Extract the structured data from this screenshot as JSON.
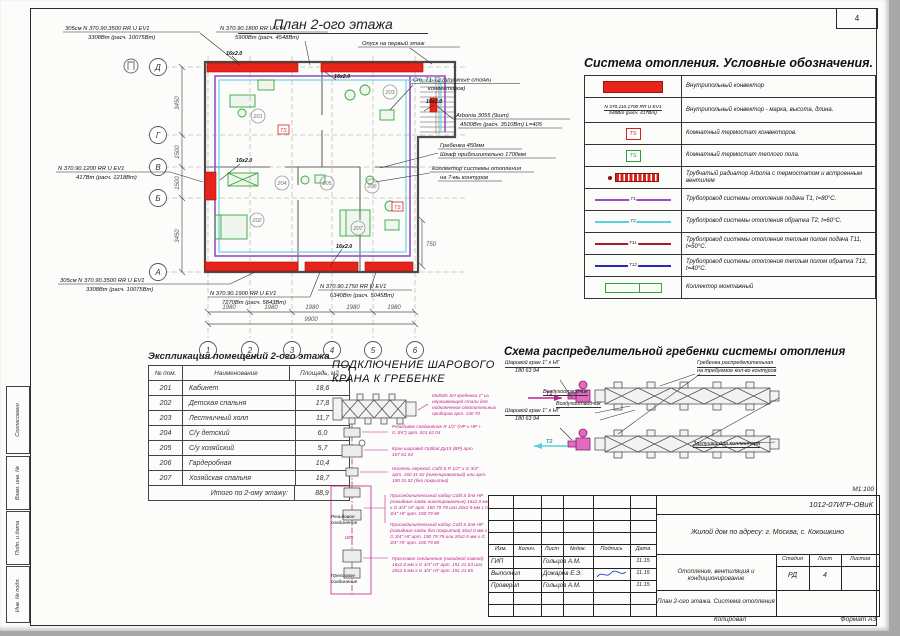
{
  "page": {
    "sheet_number": "4",
    "scale_note": "М1:100",
    "copied_label": "Копировал",
    "format_label": "Формат А3"
  },
  "margin": {
    "agreed": "Согласовано",
    "vzam_inv": "Взам. инв. №",
    "podp_data": "Подп. и дата",
    "inv_podl": "Инв. № подл."
  },
  "plan": {
    "title": "План 2-ого этажа",
    "axes_rows": [
      "Д",
      "Г",
      "В",
      "Б",
      "А"
    ],
    "axes_cols": [
      "1",
      "2",
      "3",
      "4",
      "5",
      "6"
    ],
    "dims_left": [
      "3450",
      "1500",
      "1500",
      "3450"
    ],
    "dims_bottom": [
      "1980",
      "1980",
      "1980",
      "1980",
      "1980"
    ],
    "dim_total": "9900",
    "dim_right": "750",
    "pipe_tag": "16х2.0",
    "ts_badge": "TS",
    "rooms": [
      "201",
      "202",
      "203",
      "204",
      "205",
      "206",
      "207"
    ],
    "ann": {
      "conv_tl1": "305см N 370.90.3500 RR U EV1",
      "conv_tl2": "3308Вт (расч. 10075Вт)",
      "conv_tc1": "N 370.90.1800 RR U EV1",
      "conv_tc2": "5900Вт (расч. 4548Вт)",
      "drop": "Опуск на первый этаж",
      "risers1": "Ст. Т1-Т2 (опускные стояки",
      "risers2": "конвекторов)",
      "arbonia1": "Arbonia 3055 (9шт)",
      "arbonia2": "4500Вт (расч. 3510Вт) L=405",
      "comb1": "Гребенка 450мм",
      "comb2": "Шкаф приблизительно 1700мм",
      "coll1": "Коллектор системы отопления",
      "coll2": "на 7-мь контуров",
      "conv_l1": "N 370.90.1200 RR U EV1",
      "conv_l2": "417Вт (расч. 1218Вт)",
      "conv_bl1": "305см N 370.90.3500 RR U EV1",
      "conv_bl2": "3308Вт (расч. 10075Вт)",
      "conv_bc1": "N 370.90.1900 RR U EV1",
      "conv_bc2": "7270Вт (расч. 5843Вт)",
      "conv_br1": "N 370.90.1750 RR U EV1",
      "conv_br2": "6340Вт (расч. 5045Вт)"
    }
  },
  "legend": {
    "title": "Система отопления. Условные обозначения.",
    "rows": [
      {
        "symbol": "red-bar-symbol",
        "desc": "Внутрипольный конвектор"
      },
      {
        "symbol": "convector-mark-symbol",
        "line1": "N 370.110.1700 RR U EV1",
        "line2": "548Вт (расч. 417Вт)",
        "desc": "Внутрипольный конвектор - марка, высота, длина."
      },
      {
        "symbol": "thermostat-red-symbol",
        "badge": "TS",
        "desc": "Комнатный термостат конвекторов."
      },
      {
        "symbol": "thermostat-green-symbol",
        "badge": "TS",
        "desc": "Комнатный термостат теплого пола."
      },
      {
        "symbol": "radiator-symbol",
        "desc": "Трубчатый радиатор Arbonia с термостатом и встроенным вентилем"
      },
      {
        "symbol": "supply-line-symbol",
        "tag": "Т1",
        "desc": "Трубопровод системы отопления подача Т1, t=80°С."
      },
      {
        "symbol": "return-line-symbol",
        "tag": "Т2",
        "desc": "Трубопровод системы отопления обратка Т2, t=60°С."
      },
      {
        "symbol": "floor-supply-line-symbol",
        "tag": "Т11",
        "desc": "Трубопровод системы отопления теплым полом подача Т11, t=50°С."
      },
      {
        "symbol": "floor-return-line-symbol",
        "tag": "Т12",
        "desc": "Трубопровод системы отопления теплым полом обратка Т12, t=40°С."
      },
      {
        "symbol": "collector-symbol",
        "desc": "Коллектор монтажный"
      }
    ]
  },
  "room_table": {
    "title": "Экспликация помещений 2-ого этажа",
    "headers": [
      "№ пом.",
      "Наименование",
      "Площадь, м2"
    ],
    "rows": [
      [
        "201",
        "Кабинет",
        "18,6"
      ],
      [
        "202",
        "Детская спальня",
        "17,8"
      ],
      [
        "203",
        "Лестничный холл",
        "11,7"
      ],
      [
        "204",
        "С/у детский",
        "6,0"
      ],
      [
        "205",
        "С/у хозяйский",
        "5,7"
      ],
      [
        "206",
        "Гардеробная",
        "10,4"
      ],
      [
        "207",
        "Хозяйская спальня",
        "18,7"
      ]
    ],
    "total_label": "Итого по 2-ому этажу:",
    "total_value": "88,9"
  },
  "valve_section": {
    "title1": "ПОДКЛЮЧЕНИЕ ШАРОВОГО",
    "title2": "КРАНА К ГРЕБЕНКЕ",
    "notes": [
      "Multidis SH гребенка 1\" из нержавеющей стали для подключения отопительных приборов арт. 140 70",
      "Резьбовое соединение R 1/2\" (НР х НР + G 3/4\") арт. 921 62 04",
      "Кран шаровой Optibal Ду15 (ВР) арт. 107 61 04",
      "Ниппель переход. Cofit S R 1/2\" х G 3/4\" арт. 150 31 62 (никелированный) или арт. 150 31 52 (без покрытия)",
      "Присоединительный набор Cofit S для НР (накидные гайки никелированные) 16х2.0 мм х G 3/4\" НГ арт. 150 79 78 или 20х2.5 мм х G 3/4\" НГ арт. 150 79 80",
      "Присоединительный набор Cofit S для НР (накидные гайки без покрытия) 16х2.0 мм х G 3/4\" НГ арт. 150 79 79 или 20х2.5 мм х G 3/4\" НГ арт. 150 79 80",
      "Прессовое соединение (накидной гайкой) 16х2.0 мм х G 3/4\" НГ арт. 151 21 63 или 20х2.5 мм х G 3/4\" НГ арт. 151 21 65"
    ],
    "label_threaded": "Резьбовое соединение",
    "label_or": "или",
    "label_press": "Прессовое соединение"
  },
  "scheme": {
    "title": "Схема распределительной гребенки системы отопления",
    "valve_top1": "Шаровой кран 1\" х НГ",
    "valve_top2": "180 63 94",
    "valve_bottom1": "Шаровой кран 1\" х НГ",
    "valve_bottom2": "180 63 94",
    "air_vent_top": "Воздухоотводчик",
    "air_vent_bottom": "Воздухоотводчик",
    "manifold1": "Гребенка распределительная",
    "manifold2": "на требуемое кол-во контуров",
    "plug": "Заглушка для коллектора",
    "t1": "Т1",
    "t2": "Т2"
  },
  "title_block": {
    "doc_number": "1012-07ИГР-ОВиК",
    "object": "Жилой дом по адресу: г. Москва, с. Кокошкино",
    "section": "Отопление, вентиляция и кондиционирование",
    "sheet_title": "План 2-ого этажа. Система отопления",
    "cols": {
      "izm": "Изм.",
      "kolich": "Колич.",
      "list": "Лист",
      "ndok": "№док.",
      "podpis": "Подпись",
      "data": "Дата"
    },
    "roles": [
      {
        "role": "ГИП",
        "name": "Гольцов А.М.",
        "date": "11.15"
      },
      {
        "role": "Выполнил",
        "name": "Дожарев Е.Э.",
        "date": "11.15"
      },
      {
        "role": "Проверил",
        "name": "Гольцов А.М.",
        "date": "11.15"
      }
    ],
    "stage_label": "Стадия",
    "sheet_label": "Лист",
    "sheets_label": "Листов",
    "stage": "РД",
    "sheet": "4",
    "sheets": ""
  },
  "colors": {
    "convector_red": "#e8231a",
    "supply_purple": "#9a4fc4",
    "return_cyan": "#57d2dd",
    "floor_supply": "#a6192e",
    "floor_return": "#2b2bb4",
    "collector_green": "#38a33c",
    "note_magenta": "#c0218c"
  }
}
